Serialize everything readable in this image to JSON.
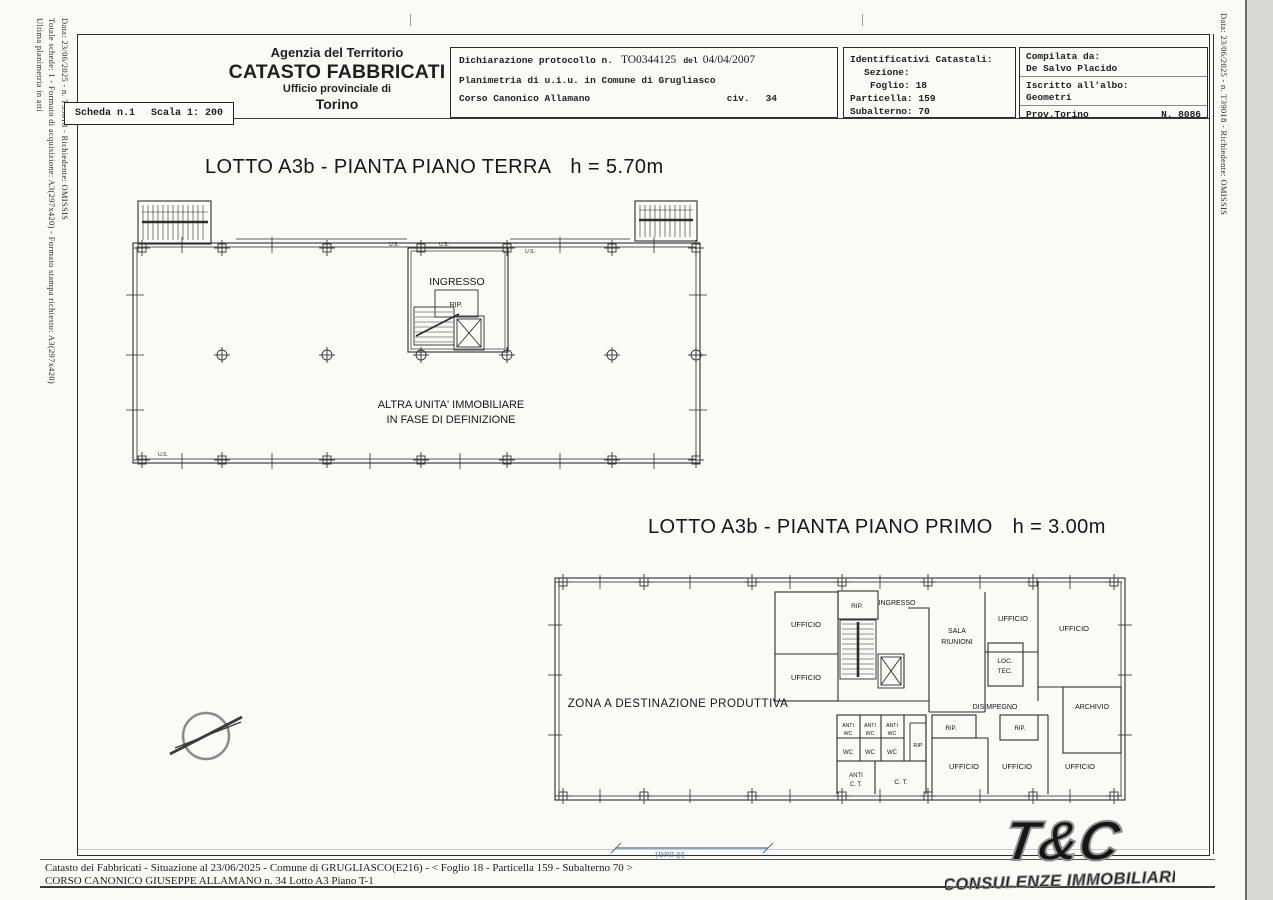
{
  "margins": {
    "left": [
      "Data: 23/06/2025 - n. T39018 - Richiedente: OMISSIS",
      "Totale schede: 1 - Formato di acquisizione: A3(297x420) - Formato stampa richiesto: A3(297x420)",
      "Ultima planimetria in atti"
    ],
    "right": "Data: 23/06/2025 - n. T39018 - Richiedente: OMISSIS"
  },
  "header": {
    "agency": [
      "Agenzia del Territorio",
      "CATASTO FABBRICATI",
      "Ufficio provinciale di",
      "Torino"
    ],
    "scheda": "Scheda n.1",
    "scala": "Scala 1: 200",
    "declaration": {
      "label": "Dichiarazione protocollo n.",
      "protocol": "TO0344125",
      "del": "del",
      "date": "04/04/2007",
      "line2": "Planimetria di u.i.u. in Comune di Grugliasco",
      "street": "Corso Canonico Allamano",
      "civ_label": "civ.",
      "civ_number": "34"
    },
    "catastali": {
      "title": "Identificativi Catastali:",
      "sezione": "Sezione:",
      "foglio": "Foglio: 18",
      "particella": "Particella: 159",
      "subalterno": "Subalterno: 70"
    },
    "compilata": {
      "label": "Compilata da:",
      "name": "De Salvo Placido",
      "albo_label": "Iscritto all'albo:",
      "albo": "Geometri",
      "prov": "Prov.Torino",
      "number": "N. 8086"
    }
  },
  "plans": {
    "ground": {
      "title": "LOTTO A3b - PIANTA PIANO TERRA",
      "h": "h = 5.70m",
      "ingresso": "INGRESSO",
      "rip": "RIP.",
      "altra1": "ALTRA UNITA' IMMOBILIARE",
      "altra2": "IN FASE DI DEFINIZIONE",
      "us": "U.S."
    },
    "first": {
      "title": "LOTTO A3b - PIANTA PIANO PRIMO",
      "h": "h = 3.00m",
      "zona": "ZONA A DESTINAZIONE  PRODUTTIVA",
      "rip": "RIP.",
      "rip_small": "RIP",
      "ingresso": "INGRESSO",
      "ufficio": "UFFICIO",
      "sala1": "SALA",
      "sala2": "RIUNIONI",
      "loc1": "LOC.",
      "loc2": "TEC.",
      "disimpegno": "DISIMPEGNO",
      "archivio": "ARCHIVIO",
      "anti": "ANTI",
      "wc": "WC",
      "ct": "C. T.",
      "anti_ct1": "ANTI",
      "anti_ct2": "C. T."
    }
  },
  "scalebar": {
    "label": "10 metri"
  },
  "footer": {
    "line1": "Catasto dei Fabbricati - Situazione al 23/06/2025 - Comune di GRUGLIASCO(E216) - < Foglio 18 - Particella  159 - Subalterno 70 >",
    "line2": "CORSO CANONICO GIUSEPPE ALLAMANO n. 34  Lotto A3 Piano T-1"
  },
  "logo": {
    "main": "T&C",
    "sub": "CONSULENZE IMMOBILIARI"
  },
  "colors": {
    "scalebar_blue": "#4a6e9b",
    "logo_outline": "#8f8f8f",
    "ink": "#1f1f1f"
  }
}
